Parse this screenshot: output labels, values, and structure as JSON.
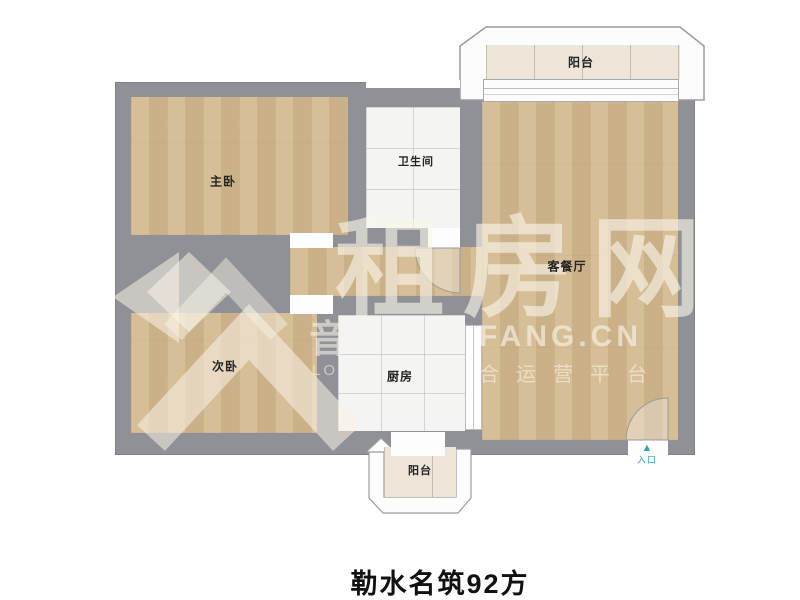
{
  "page": {
    "title": "勒水名筑92方",
    "background": "#ffffff"
  },
  "plan": {
    "colors": {
      "wall": "#8f9196",
      "wood_floor": "#d2b88e",
      "tile_floor": "#f4f4f2",
      "balcony_floor": "#ece5d8",
      "entrance_accent": "#2fa3b0"
    },
    "rooms": {
      "master_bedroom": {
        "label": "主卧"
      },
      "second_bedroom": {
        "label": "次卧"
      },
      "bathroom": {
        "label": "卫生间"
      },
      "kitchen": {
        "label": "厨房"
      },
      "living_dining": {
        "label": "客餐厅"
      },
      "balcony_top": {
        "label": "阳台"
      },
      "balcony_bottom": {
        "label": "阳台"
      }
    },
    "entrance": {
      "label": "入口",
      "arrow": "▲"
    }
  },
  "watermark": {
    "brand": "租房网",
    "domain": "FANG.CN",
    "tagline": "合运营平台",
    "side_char": "音",
    "side_sub": "LO"
  }
}
